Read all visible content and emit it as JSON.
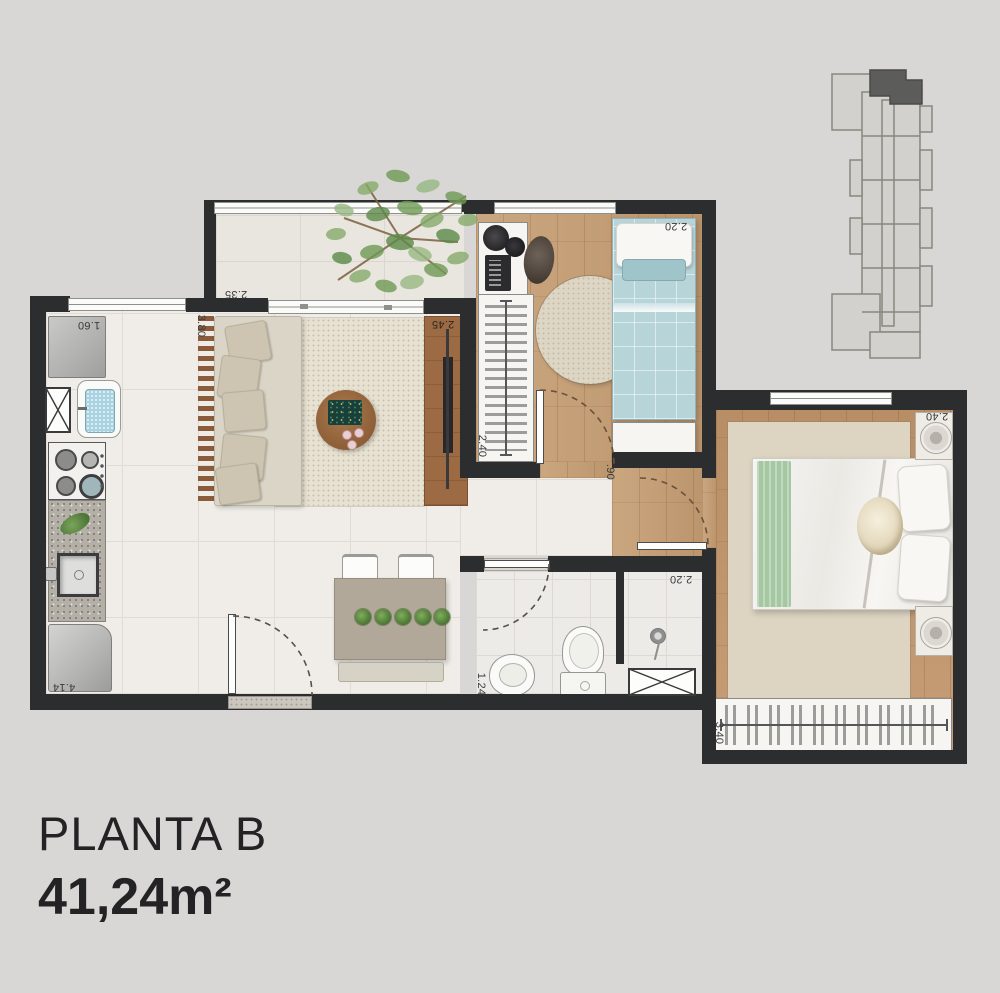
{
  "title": {
    "plan_name": "PLANTA B",
    "area": "41,24m²"
  },
  "dimensions": {
    "balcony_width": "2.35",
    "kitchen_width": "1.60",
    "living_width": "3.80",
    "living_length": "2.45",
    "bedroom1_width": "2.20",
    "bedroom1_closet": "2.40",
    "hall_door": ".90",
    "shower_width": "2.20",
    "bathroom_width": "1.24",
    "kitchen_length": "4.14",
    "bedroom2_width": "2.40",
    "bedroom2_closet": "3.40"
  },
  "colors": {
    "background": "#d8d7d5",
    "wall": "#2b2d2f",
    "wood_floor": "#c59d72",
    "tile_floor": "#f0ede8",
    "bed_blue": "#b7d4d9",
    "throw_green": "#a5c7a1",
    "keyplan_unit": "#5c5c5a"
  }
}
